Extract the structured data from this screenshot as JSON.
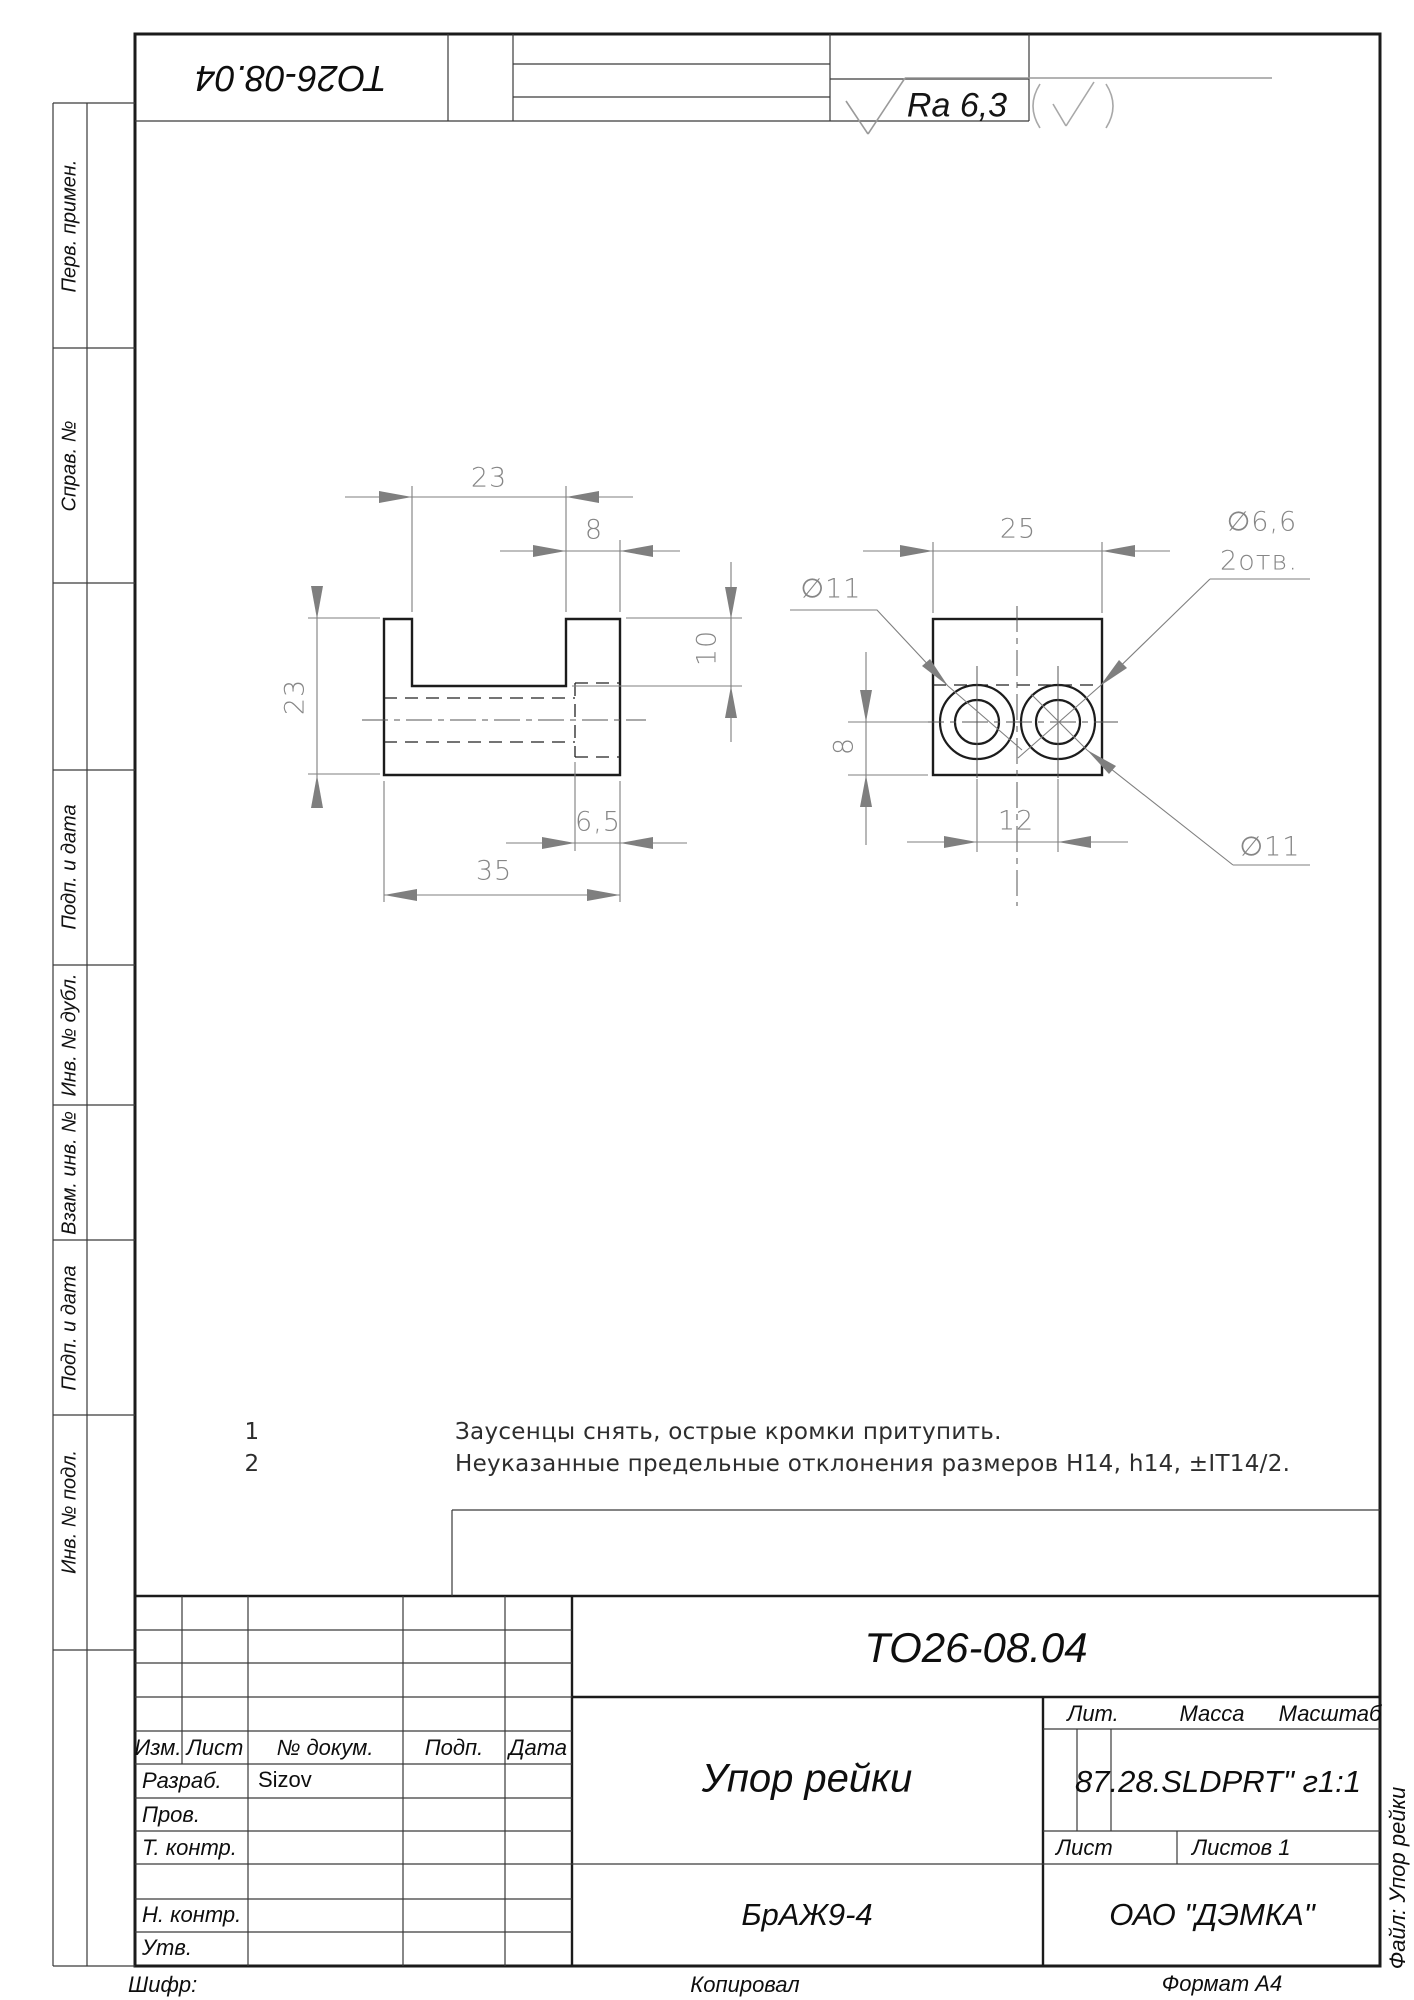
{
  "corner_stamp": {
    "designation": "ТО26-08.04"
  },
  "roughness": {
    "value": "Ra 6,3"
  },
  "front_view": {
    "dim_slot_width": "23",
    "dim_wall": "8",
    "dim_height": "23",
    "dim_slot_depth": "10",
    "dim_cbore_depth": "6,5",
    "dim_width": "35"
  },
  "side_view": {
    "dim_width": "25",
    "label_cbore_left": "∅11",
    "label_hole_d": "∅6,6",
    "label_hole_qty": "2отв.",
    "label_cbore_right": "∅11",
    "dim_center_height": "8",
    "dim_pitch": "12"
  },
  "notes": [
    {
      "num": "1",
      "text": "Заусенцы снять, острые кромки притупить."
    },
    {
      "num": "2",
      "text": "Неуказанные предельные отклонения размеров H14, h14, ±IT14/2."
    }
  ],
  "margin_labels": {
    "perv": "Перв. примен.",
    "sprav": "Справ. №",
    "podp1": "Подп. и дата",
    "inv_dubl": "Инв. № дубл.",
    "vzam": "Взам. инв. №",
    "podp2": "Подп. и дата",
    "inv_podl": "Инв. № подл."
  },
  "title_block": {
    "designation": "ТО26-08.04",
    "part_name": "Упор рейки",
    "material": "БрАЖ9-4",
    "company": "ОАО \"ДЭМКА\"",
    "mass_scale": "87.28.SLDPRT\" г1:1",
    "developer": "Sizov",
    "headers": {
      "izm": "Изм.",
      "list": "Лист",
      "doc": "№ докум.",
      "podp": "Подп.",
      "data": "Дата",
      "lit": "Лит.",
      "massa": "Масса",
      "masshtab": "Масштаб",
      "sheet": "Лист",
      "sheets": "Листов 1"
    },
    "rows": {
      "razrab": "Разраб.",
      "prov": "Пров.",
      "tkontr": "Т. контр.",
      "nkontr": "Н. контр.",
      "utv": "Утв."
    },
    "footer": {
      "shifr": "Шифр:",
      "kopiroval": "Копировал",
      "format": "Формат А4",
      "file": "Файл: Упор рейки"
    }
  }
}
